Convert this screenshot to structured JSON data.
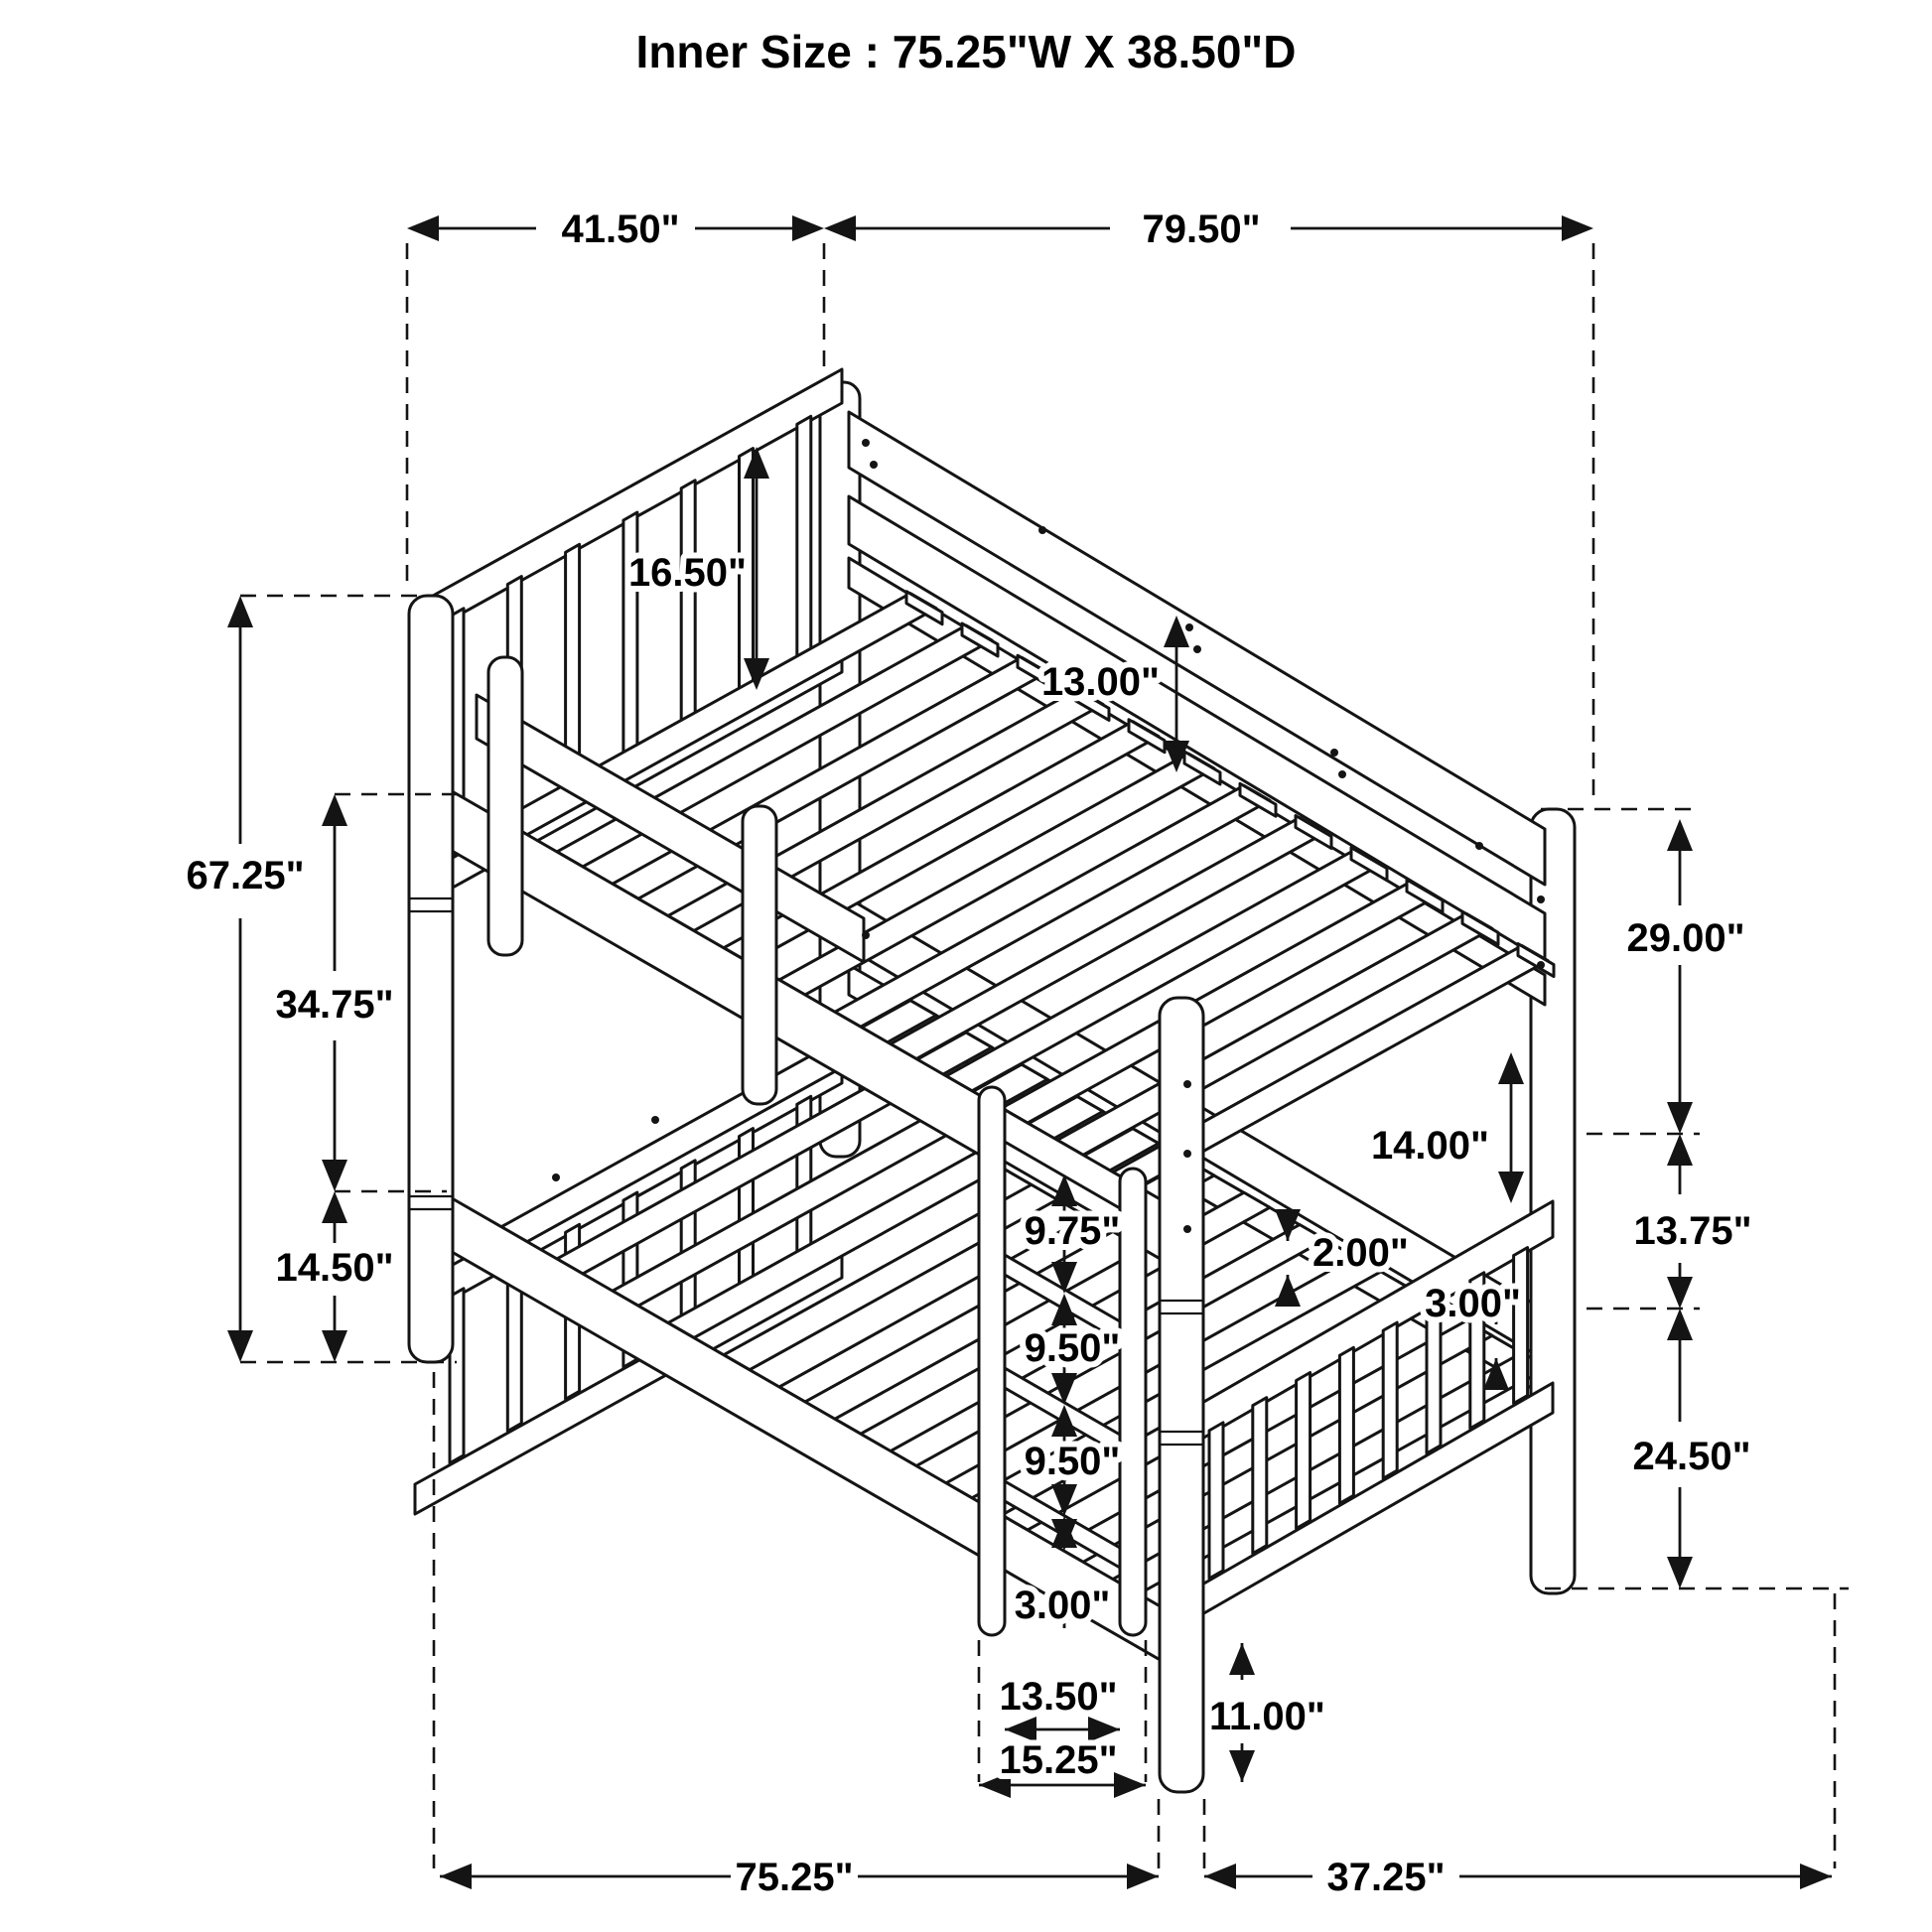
{
  "title": "Inner Size : 75.25\"W X  38.50\"D",
  "colors": {
    "line": "#141414",
    "background": "#ffffff"
  },
  "dims": {
    "top_head_width": "41.50\"",
    "top_length": "79.50\"",
    "total_height": "67.25\"",
    "deck_to_deck": "34.75\"",
    "lower_deck_height": "14.50\"",
    "head_rail_height": "16.50\"",
    "back_panel_height": "13.00\"",
    "foot_top_height": "29.00\"",
    "foot_mid_gap": "13.75\"",
    "foot_lower_height": "24.50\"",
    "guard_gap": "14.00\"",
    "slat_thickness": "2.00\"",
    "rail_thickness": "3.00\"",
    "ladder_step_1": "9.75\"",
    "ladder_step_2": "9.50\"",
    "ladder_step_3": "9.50\"",
    "ladder_step_4": "3.00\"",
    "ladder_inner_width": "13.50\"",
    "ladder_outer_width": "15.25\"",
    "under_clearance": "11.00\"",
    "bottom_length": "75.25\"",
    "bottom_depth": "37.25\""
  }
}
